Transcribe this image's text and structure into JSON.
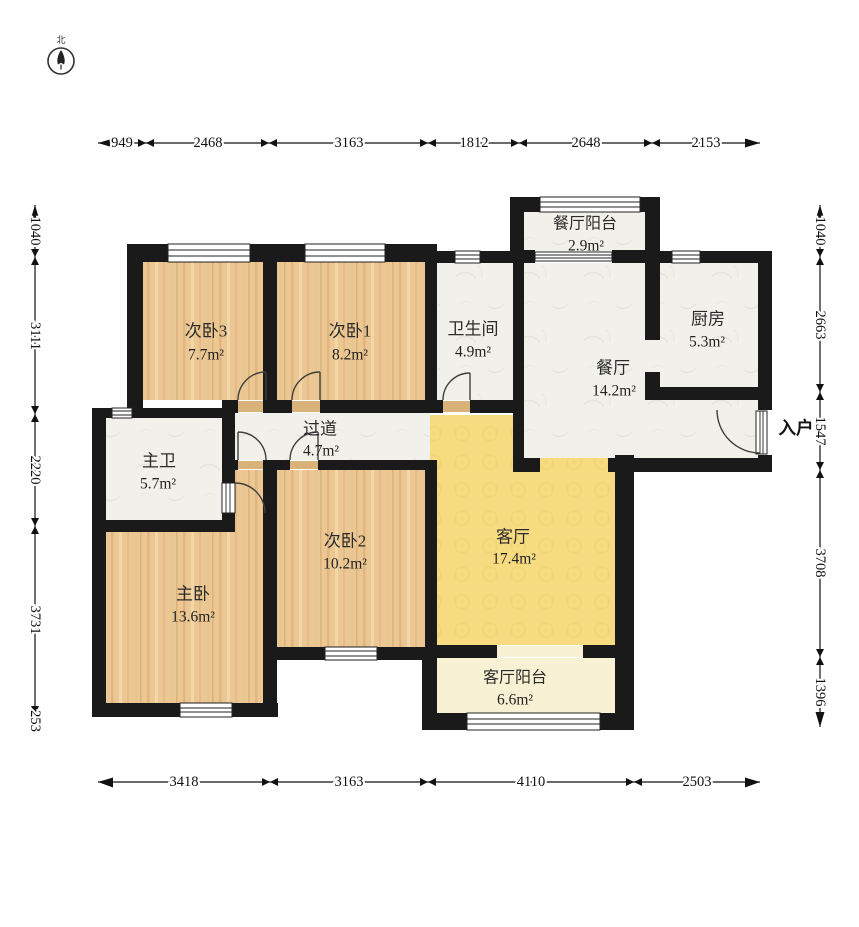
{
  "compass": {
    "north_label": "北"
  },
  "entry": {
    "label": "入户"
  },
  "rooms": [
    {
      "name": "次卧3",
      "area": "7.7m²"
    },
    {
      "name": "次卧1",
      "area": "8.2m²"
    },
    {
      "name": "卫生间",
      "area": "4.9m²"
    },
    {
      "name": "餐厅阳台",
      "area": "2.9m²"
    },
    {
      "name": "厨房",
      "area": "5.3m²"
    },
    {
      "name": "餐厅",
      "area": "14.2m²"
    },
    {
      "name": "主卫",
      "area": "5.7m²"
    },
    {
      "name": "过道",
      "area": "4.7m²"
    },
    {
      "name": "次卧2",
      "area": "10.2m²"
    },
    {
      "name": "主卧",
      "area": "13.6m²"
    },
    {
      "name": "客厅",
      "area": "17.4m²"
    },
    {
      "name": "客厅阳台",
      "area": "6.6m²"
    }
  ],
  "dimensions": {
    "top": [
      "949",
      "2468",
      "3163",
      "1812",
      "2648",
      "2153"
    ],
    "bottom": [
      "3418",
      "3163",
      "4110",
      "2503"
    ],
    "left": [
      "1040",
      "3111",
      "2220",
      "3731",
      "253"
    ],
    "right": [
      "1040",
      "2663",
      "1547",
      "3708",
      "1396"
    ]
  },
  "colors": {
    "wall": "#1a1a1a",
    "wood_floor": "#ecc794",
    "tile_floor": "#f1f0ea",
    "living_floor": "#f6db80",
    "balcony_floor": "#f8f1d4"
  }
}
